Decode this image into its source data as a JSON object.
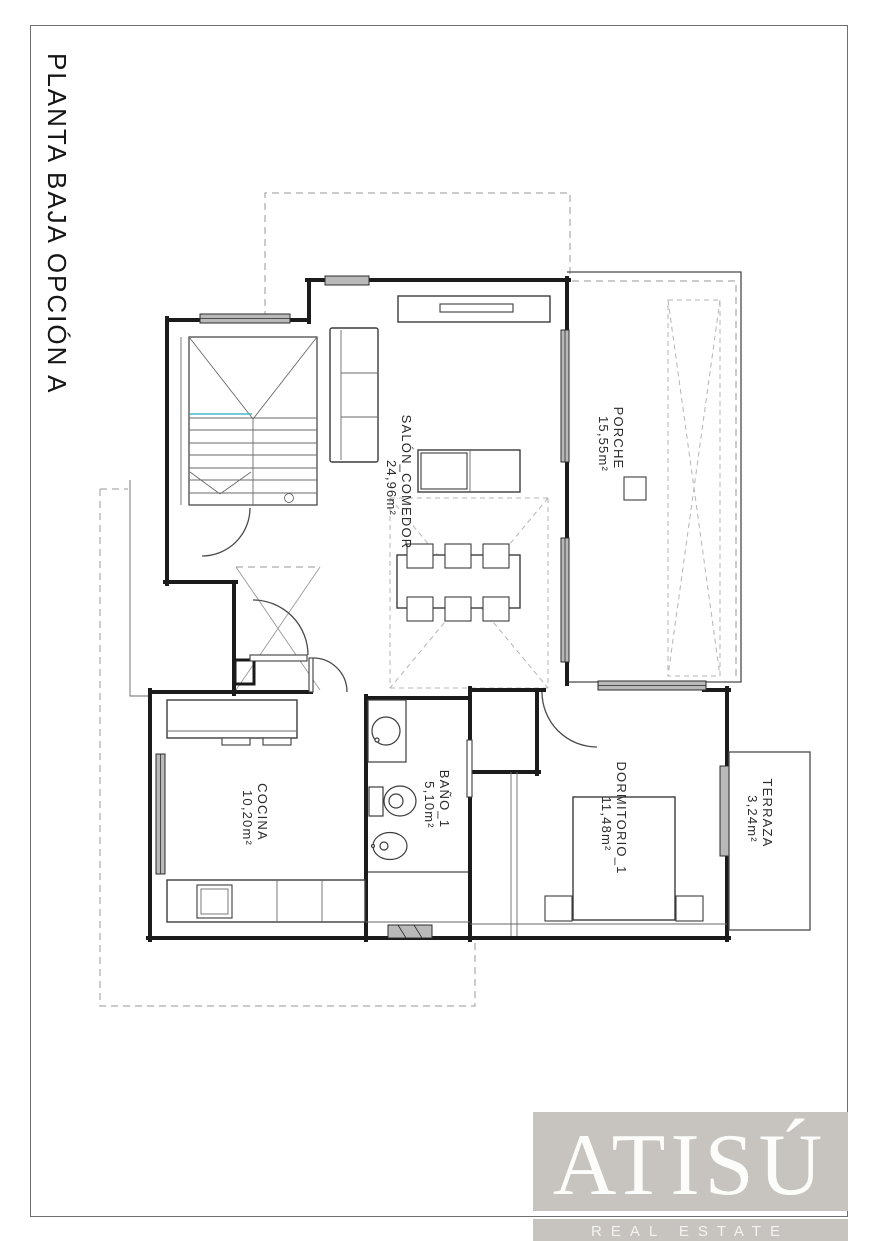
{
  "page": {
    "title": "PLANTA BAJA OPCIÓN A"
  },
  "rooms": [
    {
      "name": "SALÓN_COMEDOR",
      "area": "24,96m²"
    },
    {
      "name": "PORCHE",
      "area": "15,55m²"
    },
    {
      "name": "COCINA",
      "area": "10,20m²"
    },
    {
      "name": "BAÑO_1",
      "area": "5,10m²"
    },
    {
      "name": "DORMITORIO_1",
      "area": "11,48m²"
    },
    {
      "name": "TERRAZA",
      "area": "3,24m²"
    }
  ],
  "branding": {
    "name": "ATISÚ",
    "tagline": "REAL ESTATE"
  },
  "colors": {
    "wall": "#1b1b1b",
    "dashed_line": "#aaaaaa",
    "window_fill": "#b9b9b9",
    "stair_accent": "#45b8c8",
    "logo_background": "#c7c4bf",
    "logo_text": "#fcfcfa"
  }
}
